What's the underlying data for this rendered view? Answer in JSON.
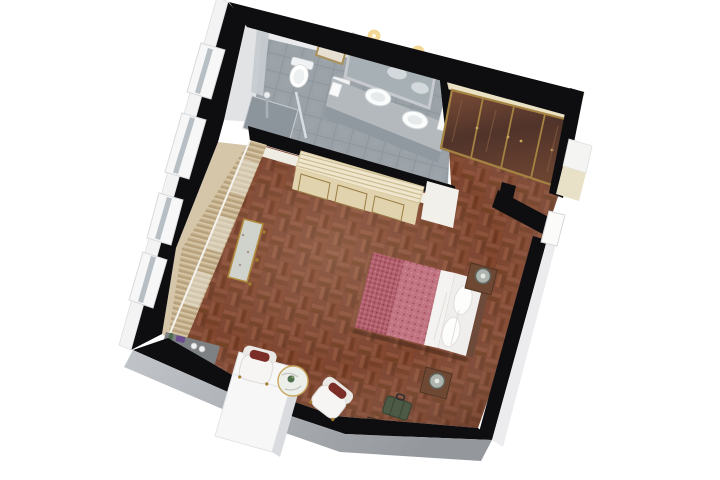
{
  "scene": {
    "title": "3D isometric cutaway floor plan of a hotel bedroom suite",
    "view": "perspective top-down, rotated ~14 degrees",
    "rooms": [
      {
        "name": "bathroom",
        "floor": "grey stone tile",
        "items": [
          "wall-hung toilet",
          "bidet",
          "double-sink vanity counter",
          "framed mirror with two lit sconces",
          "wall picture frame",
          "walk-in shower with glass panel",
          "towels",
          "exterior window box"
        ]
      },
      {
        "name": "wardrobe-nook",
        "items": [
          "built-in wardrobe with four gold-framed glass doors",
          "cream cabinet top"
        ]
      },
      {
        "name": "entry-corridor",
        "items": [
          "entry door opening",
          "exterior door alcove",
          "parquet floor"
        ]
      },
      {
        "name": "bedroom",
        "floor": "red-brown basket-weave parquet",
        "items": [
          "double bed with patterned red duvet and white pillows",
          "foot quilt",
          "two nightstands with sage lamps",
          "radiator cabinet with slatted top",
          "curtained wall with three window boxes",
          "ornate upholstered bench",
          "grey console with accessories",
          "two white armchairs with dark red cushions",
          "round marble side table with plant",
          "white chimney column",
          "luggage bench with green suitcase and red book"
        ]
      }
    ]
  },
  "palette": {
    "wall_black": "#0e0e10",
    "outer_face_white": "#f3f3f4",
    "outer_face_grey_a": "#bcbfc3",
    "outer_face_grey_b": "#989ca1",
    "bath_tile": "#9aa2a8",
    "shower_tray": "#8d959c",
    "parquet_base": "#7b4330",
    "cream_top": "#ebe2c6",
    "cabinet_front": "#e0d3ae",
    "gold_trim": "#a58343",
    "curtain": "#cbb794",
    "duvet_red": "#c17482",
    "quilt_red": "#b2606d",
    "sheet_white": "#f4f3f1",
    "cushion_red": "#7b2d28",
    "suitcase_green": "#4d5a45",
    "console_grey": "#7e8184",
    "wood_nightstand": "#6f4833",
    "mirror_glass": "#a7b0b4",
    "lamp_glow": "#f3d489"
  }
}
